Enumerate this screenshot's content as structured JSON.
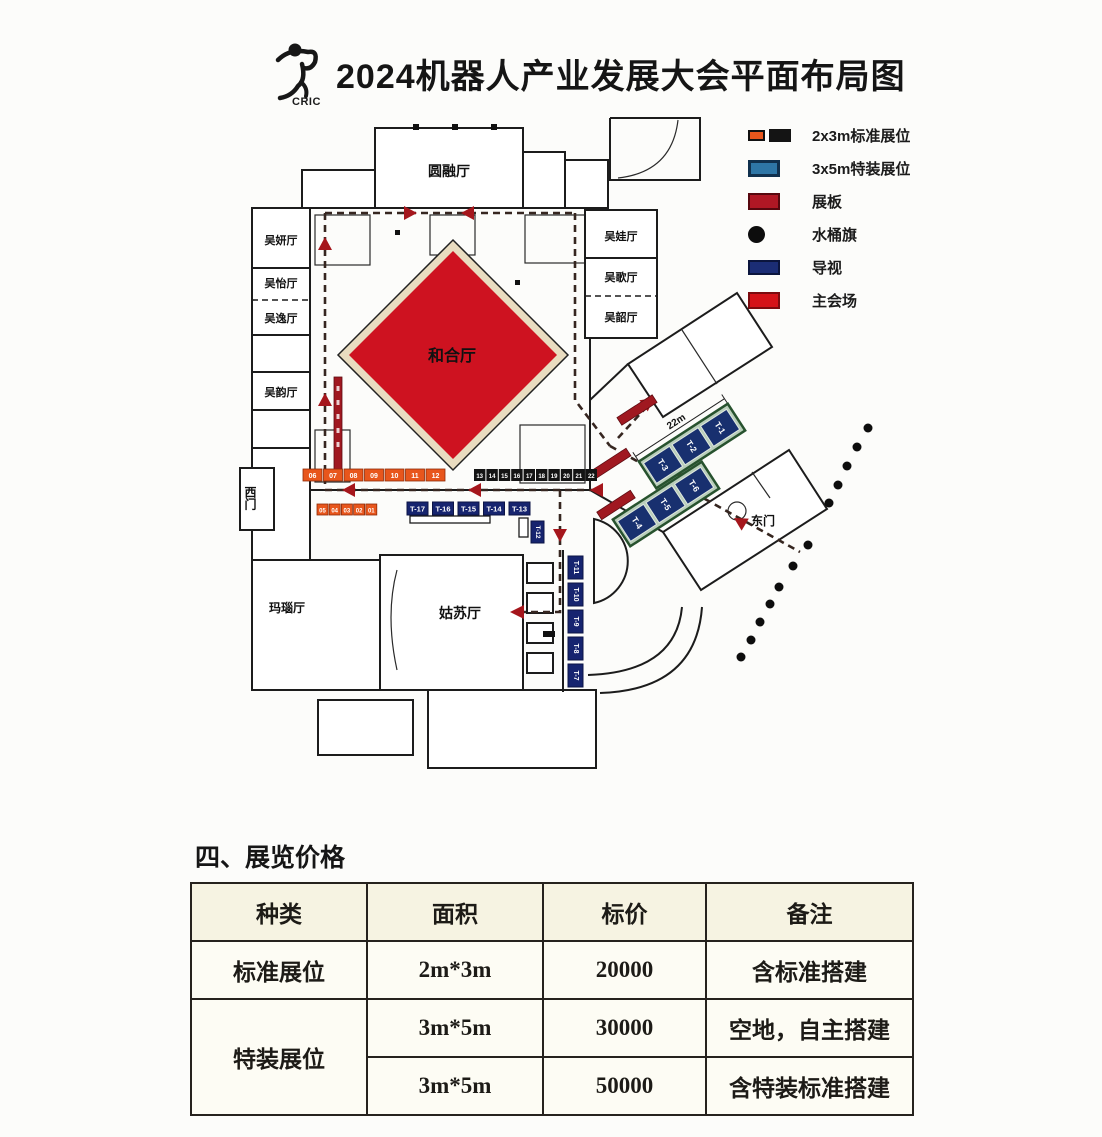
{
  "header": {
    "title": "2024机器人产业发展大会平面布局图",
    "logo_caption": "CRIC"
  },
  "legend": {
    "items": [
      {
        "label": "2x3m标准展位"
      },
      {
        "label": "3x5m特装展位"
      },
      {
        "label": "展板"
      },
      {
        "label": "水桶旗"
      },
      {
        "label": "导视"
      },
      {
        "label": "主会场"
      }
    ]
  },
  "plan": {
    "halls": {
      "yuanrong": "圆融厅",
      "hehe": "和合厅",
      "gusu": "姑苏厅",
      "manao": "玛瑙厅",
      "wuyan": "吴妍厅",
      "wuyi": "吴怡厅",
      "wuyiyi": "吴逸厅",
      "wuyun": "吴韵厅",
      "wuwa": "吴娃厅",
      "wuge": "吴歌厅",
      "wushao": "吴韶厅"
    },
    "gates": {
      "west": "西门",
      "east": "东门"
    },
    "booths": {
      "orange_row": [
        "06",
        "07",
        "08",
        "09",
        "10",
        "11",
        "12"
      ],
      "black_row": [
        "13",
        "14",
        "15",
        "16",
        "17",
        "18",
        "19",
        "20",
        "21",
        "22"
      ],
      "orange_row2": [
        "05",
        "04",
        "03",
        "02",
        "01"
      ],
      "t_row": [
        "T-17",
        "T-16",
        "T-15",
        "T-14",
        "T-13"
      ],
      "t_vertical": "T-12",
      "t_column": [
        "T-11",
        "T-10",
        "T-9",
        "T-8",
        "T-7"
      ],
      "t_strip_top": [
        "T-3",
        "T-2",
        "T-1"
      ],
      "t_strip_bottom": [
        "T-4",
        "T-5",
        "T-6"
      ]
    },
    "dimensions": {
      "strip_length": "22m"
    }
  },
  "pricing": {
    "section_title": "四、展览价格",
    "table": {
      "headers": [
        "种类",
        "面积",
        "标价",
        "备注"
      ],
      "rows": [
        {
          "type": "标准展位",
          "area": "2m*3m",
          "price": "20000",
          "note": "含标准搭建"
        },
        {
          "type": "特装展位",
          "area": "3m*5m",
          "price": "30000",
          "note": "空地，自主搭建"
        },
        {
          "type": "",
          "area": "3m*5m",
          "price": "50000",
          "note": "含特装标准搭建"
        }
      ]
    }
  },
  "colors": {
    "accent_red": "#ce1220",
    "dark_red": "#a5161c",
    "orange": "#e8561c",
    "booth_black": "#141414",
    "navy": "#1b2d75",
    "steel_blue": "#2e76a6",
    "green_strip": "#b9ceba"
  }
}
